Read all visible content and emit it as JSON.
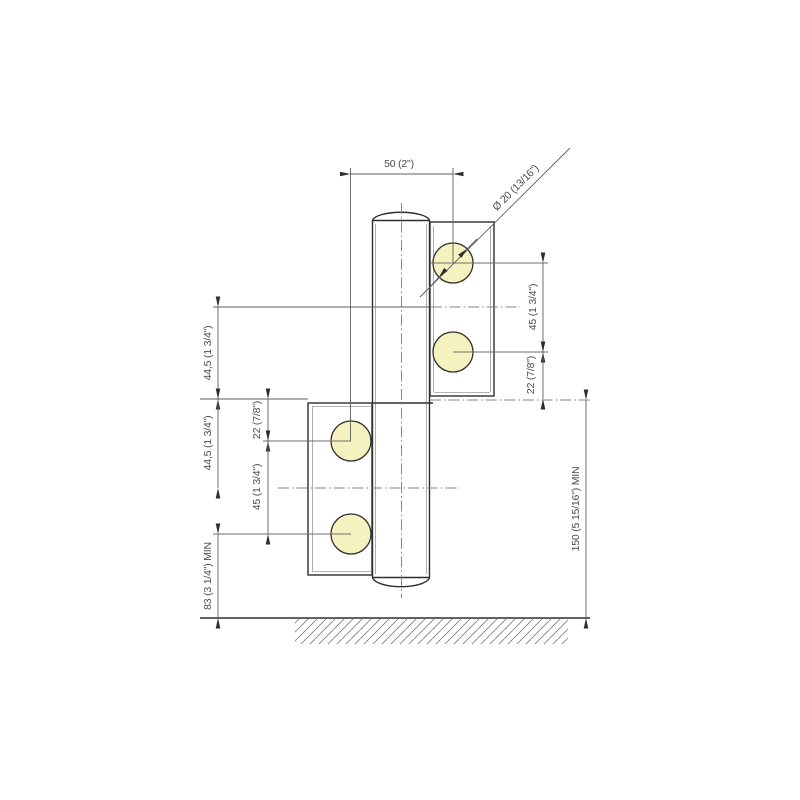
{
  "diagram": {
    "kind": "technical-drawing",
    "colors": {
      "background": "#ffffff",
      "part_outline": "#2f2f2f",
      "dimension_lines": "#5f5f5f",
      "centerlines": "#848484",
      "text": "#4d4d4d",
      "screw_hole_fill": "#f6f2bf",
      "hatch": "#808080"
    },
    "labels": {
      "top_width": "50 (2\")",
      "hole_diameter": "Ø 20 (13/16\")",
      "right_hole_spacing": "45 (1 3/4\")",
      "right_hole_to_edge": "22 (7/8\")",
      "left_top_half": "44,5 (1 3/4\")",
      "left_bottom_half": "44,5 (1 3/4\")",
      "left_edge_to_hole": "22 (7/8\")",
      "left_hole_spacing": "45 (1 3/4\")",
      "floor_min_hole": "83 (3 1/4\") MIN",
      "floor_min_center": "150 (5 15/16\") MIN"
    },
    "parts": [
      "hinge-barrel",
      "top-leaf",
      "bottom-leaf",
      "screw-holes",
      "floor"
    ]
  }
}
